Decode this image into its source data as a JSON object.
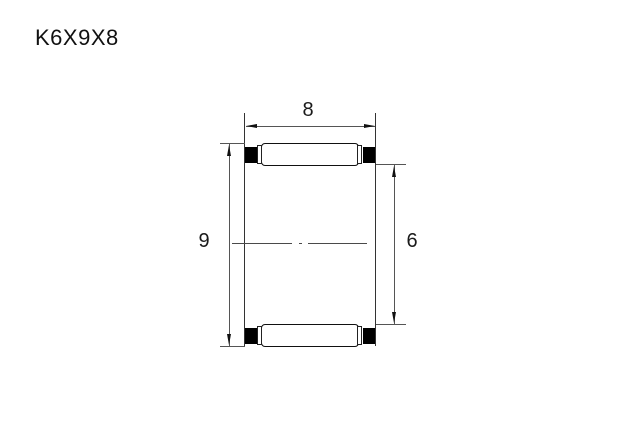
{
  "title": "K6X9X8",
  "drawing": {
    "type": "bearing-cross-section",
    "part_number": "K6X9X8",
    "dim_width": {
      "label": "8",
      "meaning": "overall width"
    },
    "dim_outer": {
      "label": "9",
      "meaning": "outer envelope diameter"
    },
    "dim_bore": {
      "label": "6",
      "meaning": "bore / inner envelope diameter"
    }
  },
  "colors": {
    "background": "#ffffff",
    "outline": "#111111",
    "thin_line": "#555555",
    "cage_fill": "#000000"
  }
}
